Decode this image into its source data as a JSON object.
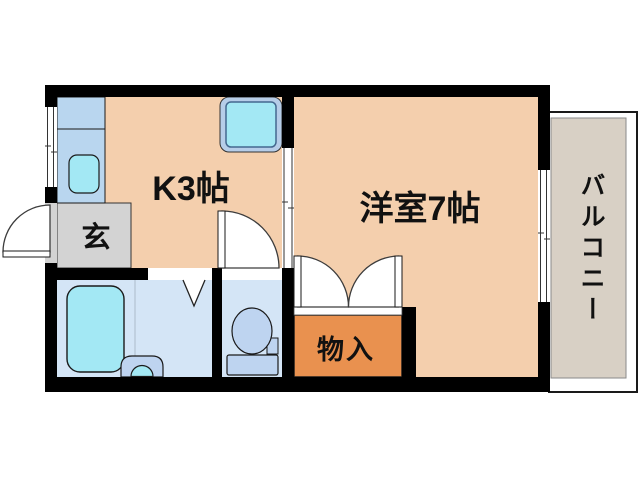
{
  "floor_plan": {
    "rooms": {
      "kitchen": {
        "label": "K3帖"
      },
      "western_room": {
        "label": "洋室7帖"
      },
      "entrance": {
        "label": "玄"
      },
      "storage": {
        "label": "物入"
      },
      "balcony": {
        "label": "バルコニー"
      }
    },
    "colors": {
      "wall": "#000000",
      "room_floor": "#f4cfad",
      "wet_area_floor": "#d4e5f6",
      "entrance_floor": "#d3d3d3",
      "storage_floor": "#e9914f",
      "balcony_floor": "#d8d0c5",
      "counter_blue": "#b9d6ef",
      "water_cyan": "#a3e8f4",
      "fixture_blue": "#bed4f0",
      "appliance_frame": "#b6cde8",
      "background": "#ffffff"
    }
  }
}
